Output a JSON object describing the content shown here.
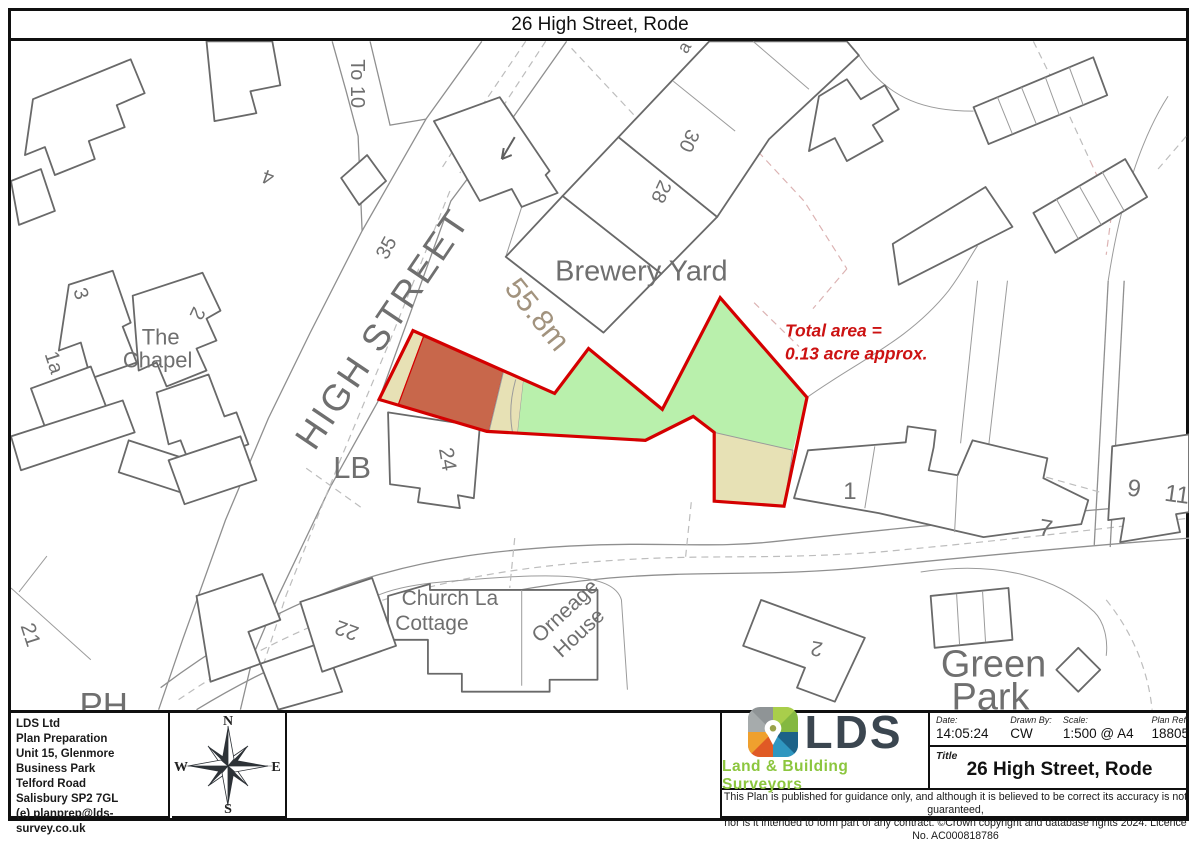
{
  "title_bar": {
    "text": "26 High Street, Rode"
  },
  "map": {
    "dimension_label": "55.8m",
    "area_note_line1": "Total area =",
    "area_note_line2": "0.13 acre approx.",
    "labels": [
      {
        "text": "To 10"
      },
      {
        "text": "4"
      },
      {
        "text": "35"
      },
      {
        "text": "HIGH STREET"
      },
      {
        "text": "Brewery Yard"
      },
      {
        "text": "30"
      },
      {
        "text": "28"
      },
      {
        "text": "The"
      },
      {
        "text": "Chapel"
      },
      {
        "text": "3"
      },
      {
        "text": "1a"
      },
      {
        "text": "2"
      },
      {
        "text": "LB"
      },
      {
        "text": "24"
      },
      {
        "text": "1"
      },
      {
        "text": "7"
      },
      {
        "text": "9"
      },
      {
        "text": "11"
      },
      {
        "text": "21"
      },
      {
        "text": "PH"
      },
      {
        "text": "22"
      },
      {
        "text": "Church La"
      },
      {
        "text": "Cottage"
      },
      {
        "text": "Orneage"
      },
      {
        "text": "House"
      },
      {
        "text": "2"
      },
      {
        "text": "Green"
      },
      {
        "text": "Park"
      },
      {
        "text": "a"
      }
    ],
    "colors": {
      "plot_outline": "#d40000",
      "building_fill": "#c8674b",
      "tan_fill": "#e7e1b5",
      "green_fill": "#b9f0ac"
    }
  },
  "footer": {
    "company": {
      "line1": "LDS Ltd",
      "line2": "Plan Preparation",
      "line3": "Unit 15, Glenmore Business Park",
      "line4": "Telford Road",
      "line5": "Salisbury SP2 7GL",
      "email": "(e) planprep@lds-survey.co.uk"
    },
    "compass": {
      "n": "N",
      "e": "E",
      "s": "S",
      "w": "W"
    },
    "logo": {
      "text": "LDS",
      "tagline": "Land & Building Surveyors"
    },
    "titleblock": {
      "date_label": "Date:",
      "date": "14:05:24",
      "drawn_label": "Drawn By:",
      "drawn": "CW",
      "scale_label": "Scale:",
      "scale": "1:500 @ A4",
      "ref_label": "Plan Ref:",
      "ref": "18805",
      "title_label": "Title",
      "title": "26 High Street, Rode"
    },
    "disclaimer": {
      "line1": "This Plan is published for guidance only, and although it is believed to be correct its accuracy is not guaranteed,",
      "line2": "nor is it intended to form part of any contract. ©Crown copyright and database rights 2024. Licence No. AC000818786"
    }
  }
}
